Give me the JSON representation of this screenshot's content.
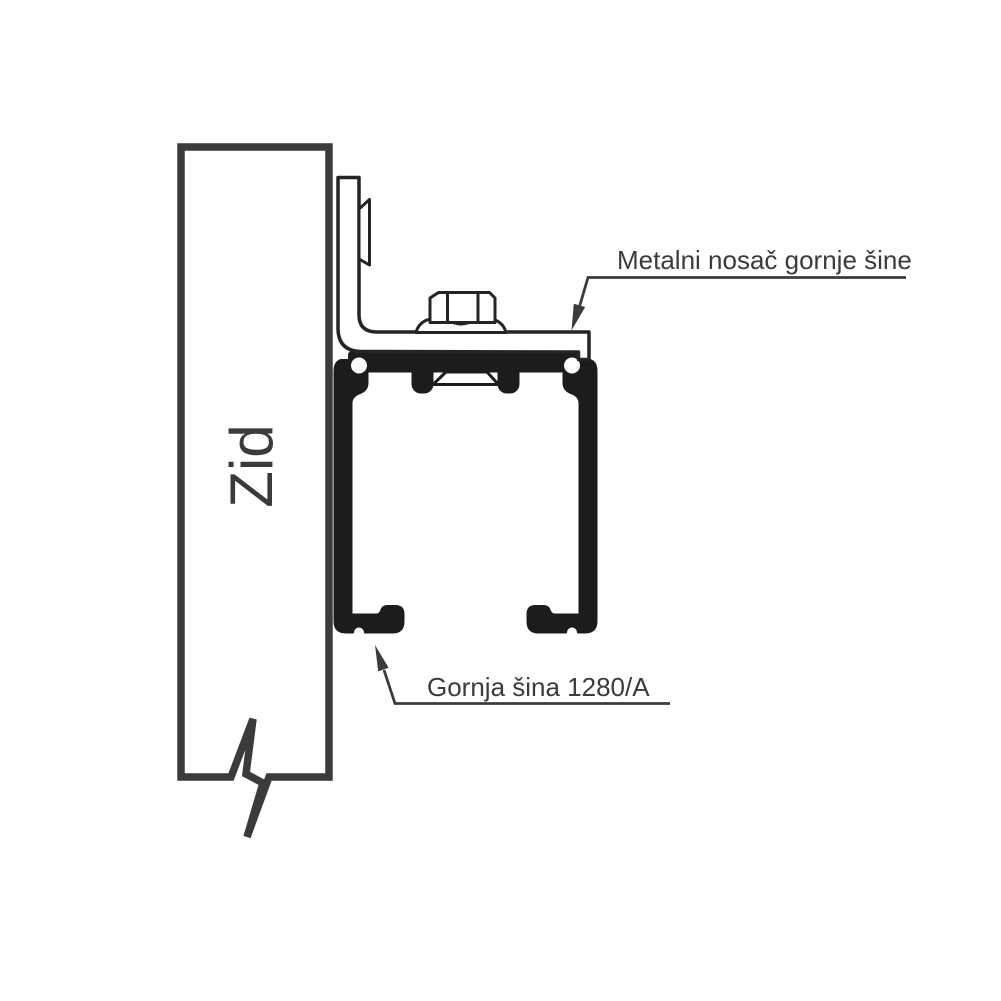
{
  "diagram": {
    "wall": {
      "label": "Zid"
    },
    "callouts": {
      "bracket": {
        "label": "Metalni nosač gornje šine"
      },
      "rail": {
        "label": "Gornja šina 1280/A"
      }
    },
    "colors": {
      "background": "#ffffff",
      "wall_outline": "#3b3b3b",
      "drawing_line": "#242424",
      "profile_fill": "#1c1c1c",
      "annotation_text": "#3b3b3b"
    }
  }
}
